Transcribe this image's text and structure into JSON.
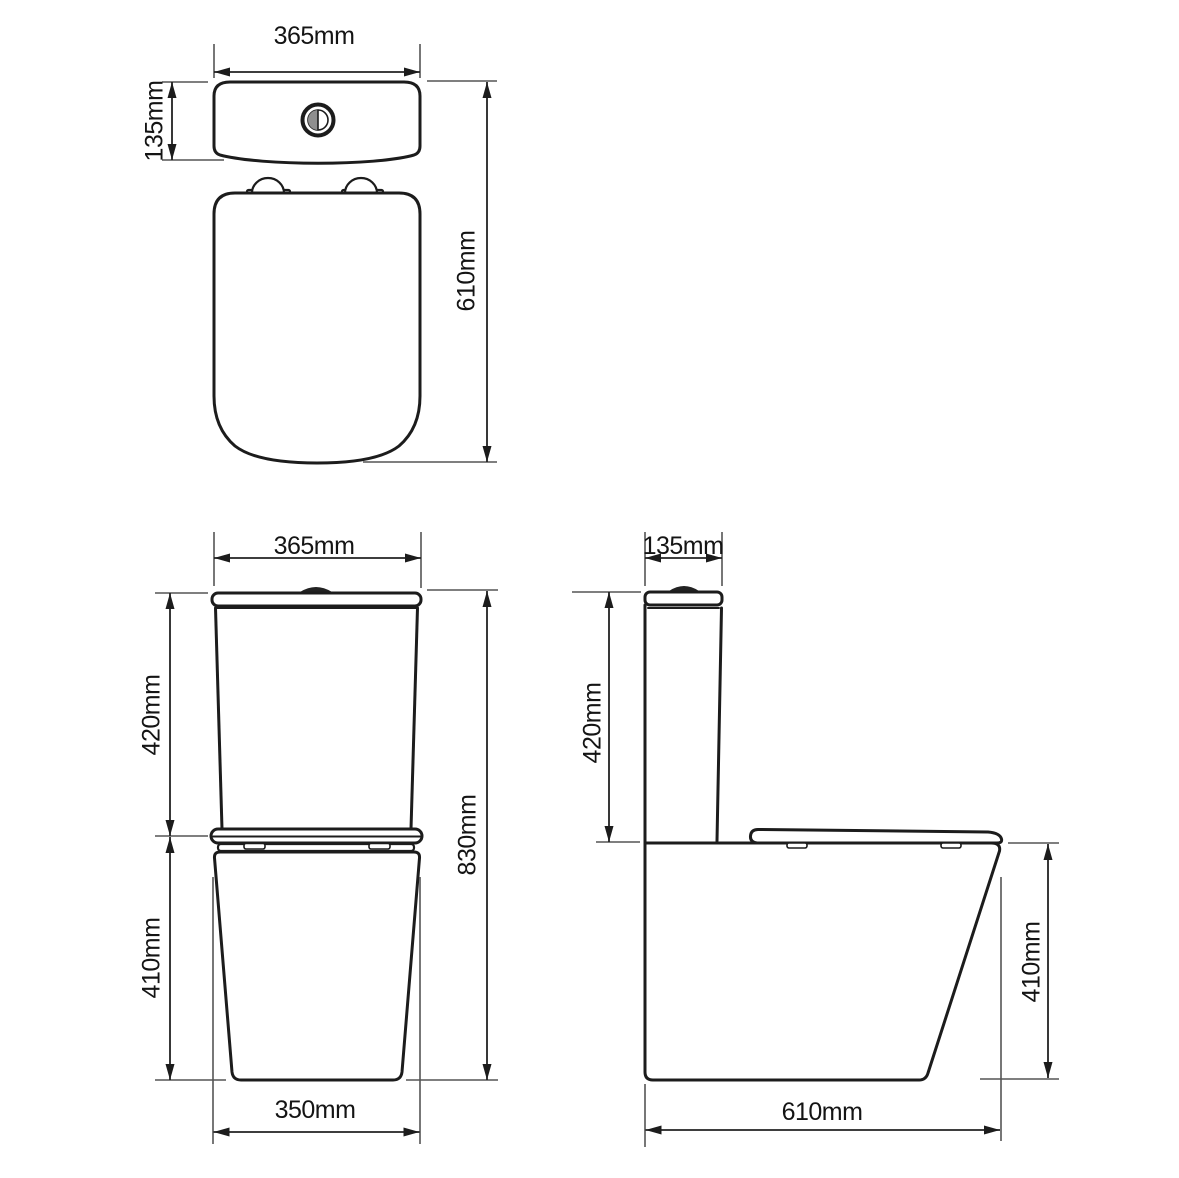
{
  "views": {
    "top": {
      "width": "365mm",
      "cistern_depth": "135mm",
      "total_depth": "610mm"
    },
    "front": {
      "width": "365mm",
      "cistern_height": "420mm",
      "total_height": "830mm",
      "pan_height": "410mm",
      "base_width": "350mm"
    },
    "side": {
      "cistern_depth": "135mm",
      "cistern_height": "420mm",
      "pan_height": "410mm",
      "total_depth": "610mm"
    }
  },
  "colors": {
    "outline": "#1c1c1c",
    "dimension": "#222222",
    "extension": "#555555",
    "text": "#141414",
    "background": "#ffffff",
    "flush_button_gray": "#8f8f8f",
    "flush_button_dark": "#222222"
  }
}
